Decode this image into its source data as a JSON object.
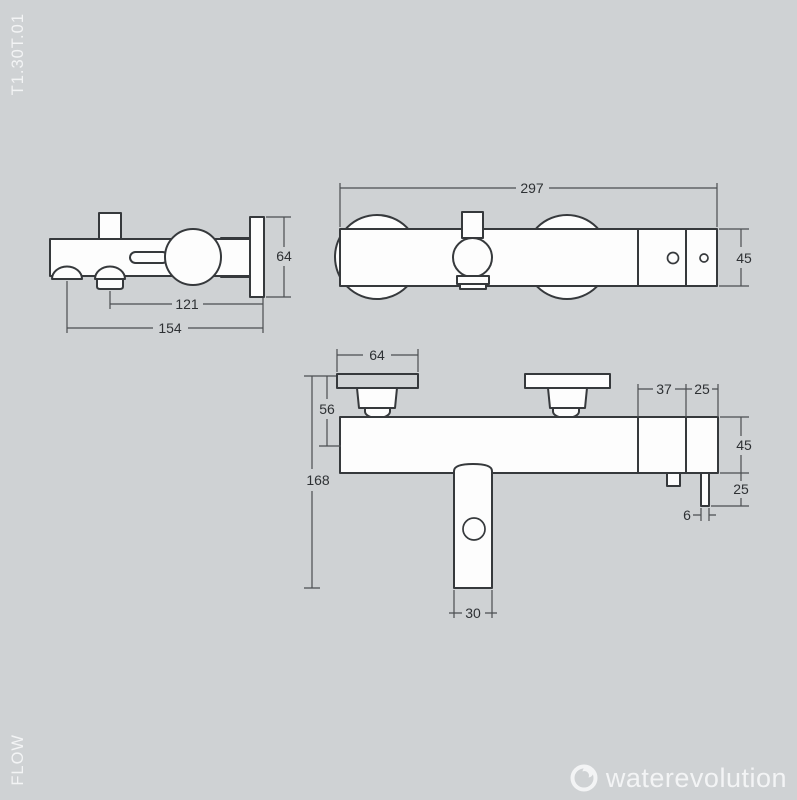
{
  "page": {
    "background_color": "#cfd2d4",
    "line_color": "#36393c",
    "dim_text_color": "#2e3134",
    "light_text_color": "#f3f4f5"
  },
  "labels": {
    "model_code": "T1.30T.01",
    "series_name": "FLOW"
  },
  "brand": {
    "name": "waterevolution",
    "logo_icon": "water-drop-ring-icon"
  },
  "views": {
    "side": {
      "dim_plate_height": "64",
      "dim_outlet_to_wall": "121",
      "dim_projection": "154"
    },
    "front": {
      "dim_width": "297",
      "dim_height": "45"
    },
    "plan": {
      "dim_plate_width": "64",
      "dim_plate_offset": "56",
      "dim_total_drop": "168",
      "dim_section_a": "37",
      "dim_section_b": "25",
      "dim_body_depth": "45",
      "dim_tube_drop": "25",
      "dim_tube_width": "6",
      "dim_spout_width": "30"
    }
  }
}
